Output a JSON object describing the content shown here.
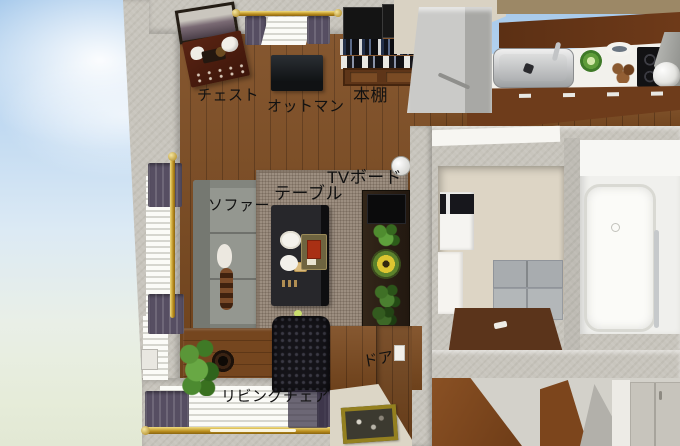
{
  "labels": {
    "chest": "チェスト",
    "ottoman": "オットマン",
    "bookshelf": "本棚",
    "table": "テーブル",
    "tv_board": "TVボード",
    "sofa": "ソファー",
    "door": "ドア",
    "living_chair": "リビングチェア"
  },
  "colors": {
    "sky_top": "#a6c9eb",
    "sky_horizon": "#e6ecd9",
    "wall": "#c8c5bd",
    "floor_wood": "#7c4a1f",
    "rug": "#9c8e80",
    "sofa": "#898c85",
    "curtain": "#564e62",
    "curtain_rod_gold": "#bb8f1f",
    "kitchen_counter": "#f2f1ec",
    "cabinet_wood": "#6e3c1b",
    "label_text": "#111111"
  }
}
